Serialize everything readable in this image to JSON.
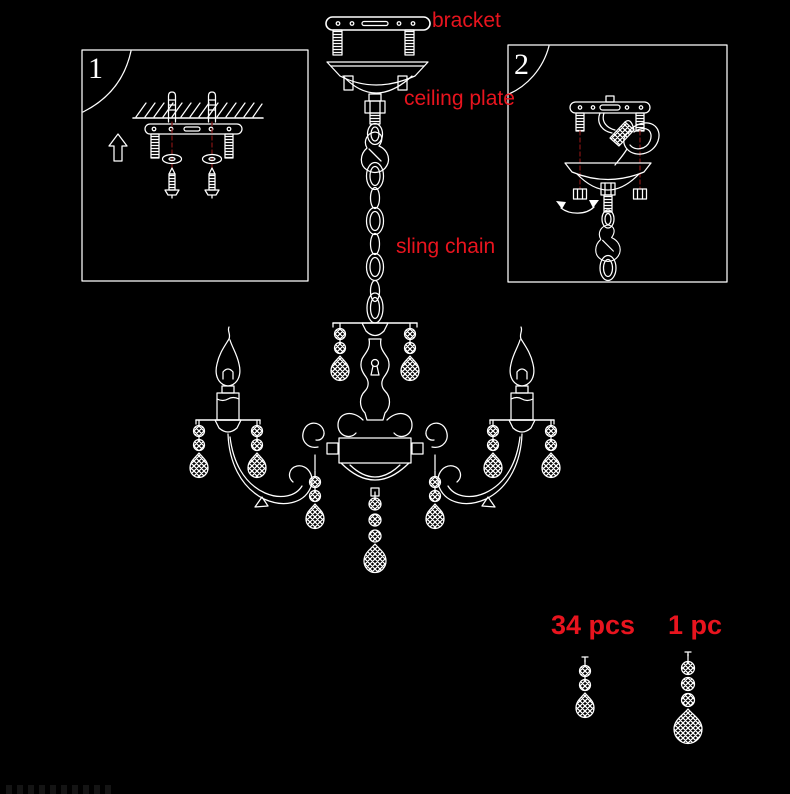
{
  "canvas": {
    "background_color": "#000000",
    "line_color": "#ffffff",
    "label_color": "#e8141e",
    "guide_line_color": "#7a1212"
  },
  "annotations": {
    "bracket": "bracket",
    "ceiling_plate": "ceiling plate",
    "sling_chain": "sling chain"
  },
  "step_boxes": [
    {
      "number": "1",
      "diagram": "ceiling-anchors-and-mounting-screws"
    },
    {
      "number": "2",
      "diagram": "bracket-wiring-and-canopy-nuts"
    }
  ],
  "crystal_counts": [
    {
      "label": "34 pcs",
      "drop": "small-crystal-pendant"
    },
    {
      "label": "1 pc",
      "drop": "large-crystal-pendant"
    }
  ]
}
